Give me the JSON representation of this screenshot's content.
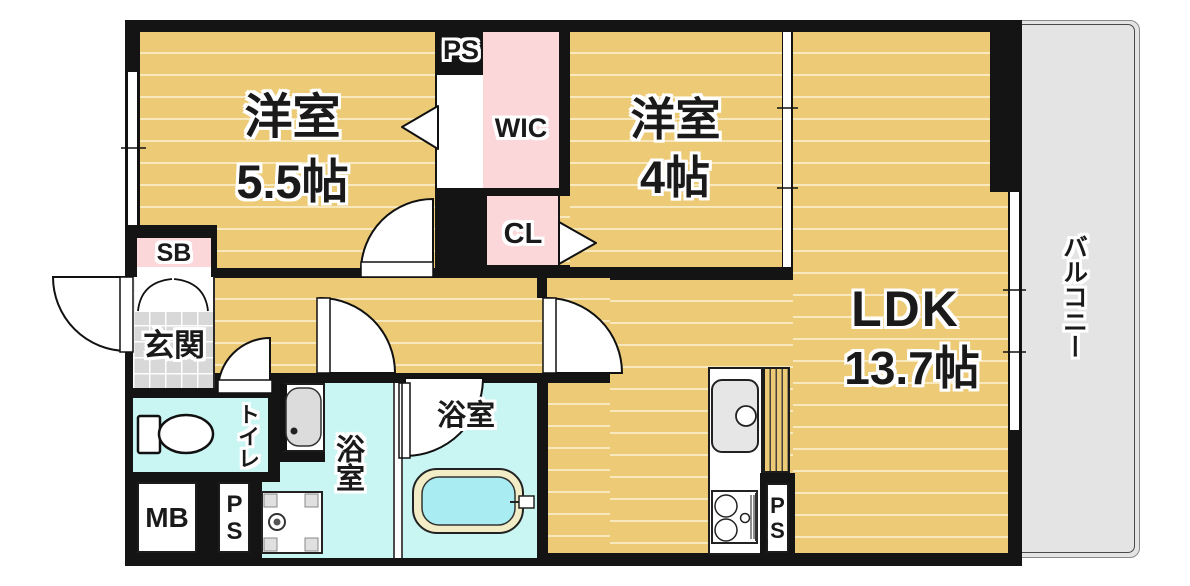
{
  "rooms": {
    "bedroom1": {
      "label": "洋室",
      "size": "5.5帖"
    },
    "bedroom2": {
      "label": "洋室",
      "size": "4帖"
    },
    "ldk": {
      "label": "LDK",
      "size": "13.7帖"
    },
    "wic": {
      "label": "WIC"
    },
    "closet": {
      "label": "CL"
    },
    "shoebox": {
      "label": "SB"
    },
    "meterbox": {
      "label": "MB"
    },
    "pipe_space_top": {
      "label": "PS"
    },
    "pipe_space_left": {
      "label": "PS"
    },
    "pipe_space_kitchen": {
      "label": "PS"
    },
    "entrance": {
      "label": "玄関"
    },
    "toilet": {
      "label": "トイレ"
    },
    "washroom": {
      "label": "浴室"
    },
    "bathroom": {
      "label": "浴室"
    },
    "balcony": {
      "label": "バルコニー"
    }
  },
  "colors": {
    "floor": "#ecca76",
    "floor_line": "#f7e9bd",
    "pink": "#fbd7d9",
    "cyan": "#c9f6f3",
    "tile": "#d8d8d8",
    "balcony": "#e4e4e4",
    "wall": "#141414",
    "tub_rim": "#f2edc6",
    "tub_water": "#a9ecf1",
    "text": "#1a1a1a"
  }
}
